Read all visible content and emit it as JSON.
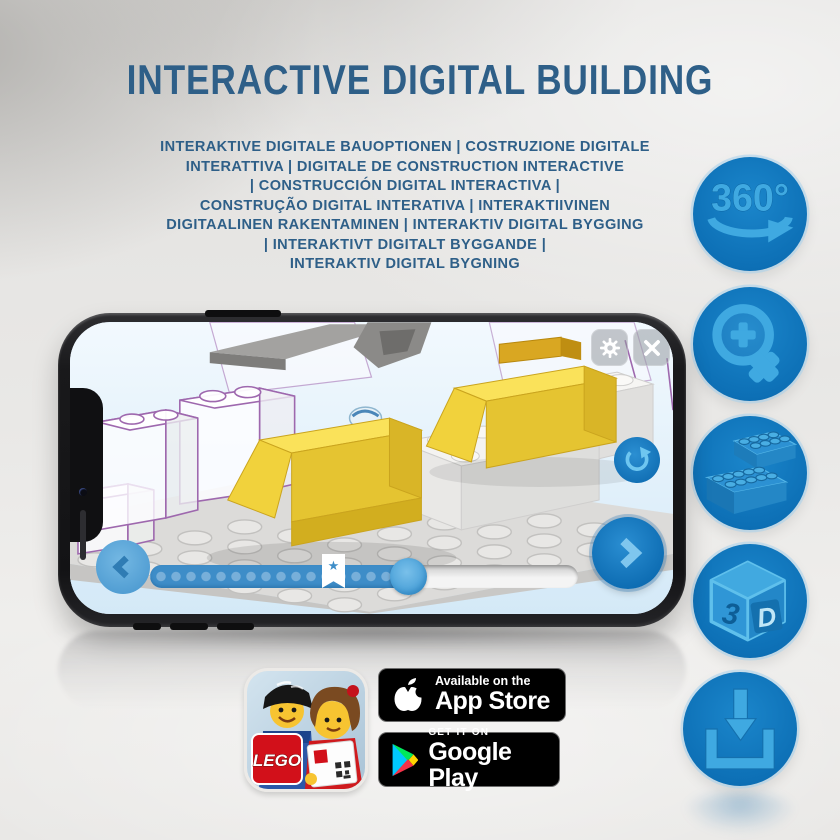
{
  "title": "INTERACTIVE DIGITAL BUILDING",
  "subtitle_lines": [
    "INTERAKTIVE DIGITALE BAUOPTIONEN | COSTRUZIONE DIGITALE",
    "INTERATTIVA | DIGITALE DE CONSTRUCTION INTERACTIVE",
    "| CONSTRUCCIÓN DIGITAL INTERACTIVA |",
    "CONSTRUÇÃO DIGITAL INTERATIVA | INTERAKTIIVINEN",
    "DIGITAALINEN RAKENTAMINEN | INTERAKTIV DIGITAL BYGGING",
    "| INTERAKTIVT DIGITALT BYGGANDE |",
    "INTERAKTIV DIGITAL BYGNING"
  ],
  "features": [
    {
      "name": "rotate-360",
      "label": "360°"
    },
    {
      "name": "zoom-in"
    },
    {
      "name": "bricks"
    },
    {
      "name": "view-3d",
      "digit": "3",
      "letter": "D"
    },
    {
      "name": "download"
    }
  ],
  "phone_app": {
    "progress_star_glyph": "★"
  },
  "badges": {
    "lego_logo_text": "LEGO",
    "app_store": {
      "line1": "Available on the",
      "line2": "App Store"
    },
    "google_play": {
      "line1": "GET IT ON",
      "line2": "Google Play"
    }
  },
  "colors": {
    "headline_blue": "#2e5f88",
    "circle_blue": "#0d70b6",
    "glyph_blue": "#3fa9e1",
    "progress_blue": "#3e8dc8",
    "brick_yellow": "#f6d93a"
  }
}
